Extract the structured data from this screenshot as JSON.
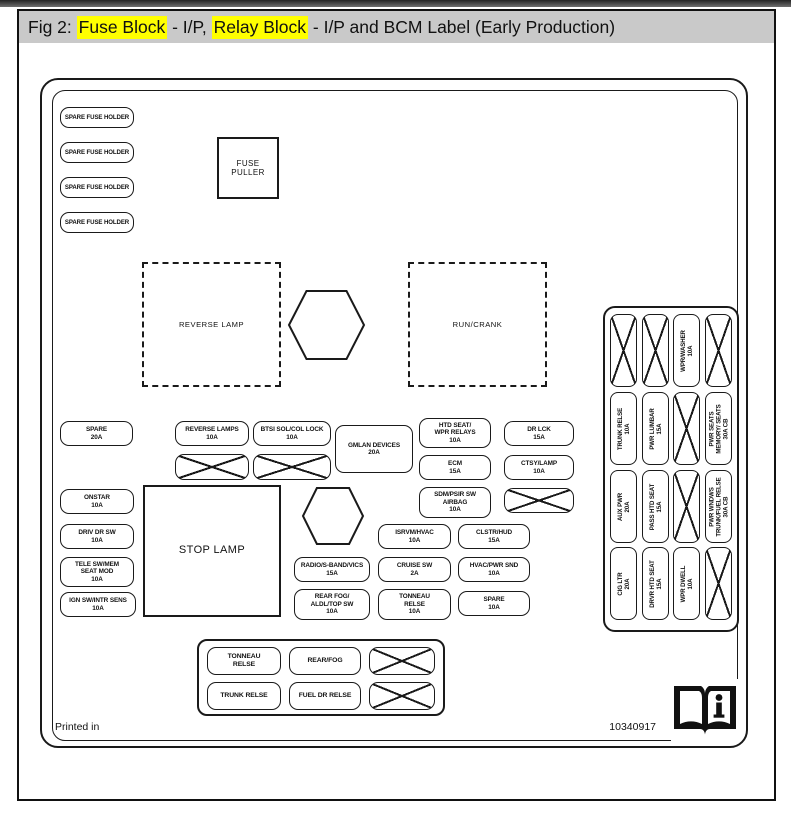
{
  "caption": {
    "prefix": "Fig 2: ",
    "fuse_block": "Fuse Block",
    "sep1": " - I/P, ",
    "relay_block": "Relay Block",
    "sep2": " - I/P and BCM Label (Early Production)"
  },
  "colors": {
    "highlight": "#ffff00",
    "caption_bg": "#c9c9c9",
    "line": "#1a1a1a"
  },
  "diagram": {
    "spare_fuse_holders": [
      "SPARE FUSE HOLDER",
      "SPARE FUSE HOLDER",
      "SPARE FUSE HOLDER",
      "SPARE FUSE HOLDER"
    ],
    "fuse_puller_lines": [
      "FUSE",
      "PULLER"
    ],
    "dashed_boxes": [
      {
        "label": "REVERSE LAMP",
        "x": 142,
        "y": 262,
        "w": 139,
        "h": 125
      },
      {
        "label": "RUN/CRANK",
        "x": 408,
        "y": 262,
        "w": 139,
        "h": 125
      }
    ],
    "stop_lamp": {
      "label": "STOP LAMP",
      "x": 143,
      "y": 485,
      "w": 138,
      "h": 132
    },
    "hexagons": [
      {
        "x": 288,
        "y": 290,
        "w": 77,
        "h": 70
      },
      {
        "x": 302,
        "y": 487,
        "w": 62,
        "h": 58
      }
    ],
    "fuses": [
      {
        "x": 60,
        "y": 421,
        "w": 73,
        "h": 25,
        "lines": [
          "SPARE",
          "20A"
        ]
      },
      {
        "x": 175,
        "y": 421,
        "w": 74,
        "h": 25,
        "lines": [
          "REVERSE LAMPS",
          "10A"
        ]
      },
      {
        "x": 253,
        "y": 421,
        "w": 78,
        "h": 25,
        "lines": [
          "BTSI SOL/COL LOCK",
          "10A"
        ]
      },
      {
        "x": 335,
        "y": 425,
        "w": 78,
        "h": 48,
        "lines": [
          "GMLAN DEVICES",
          "20A"
        ]
      },
      {
        "x": 419,
        "y": 418,
        "w": 72,
        "h": 30,
        "lines": [
          "HTD SEAT/",
          "WPR RELAYS",
          "10A"
        ]
      },
      {
        "x": 504,
        "y": 421,
        "w": 70,
        "h": 25,
        "lines": [
          "DR LCK",
          "15A"
        ]
      },
      {
        "x": 419,
        "y": 455,
        "w": 72,
        "h": 25,
        "lines": [
          "ECM",
          "15A"
        ]
      },
      {
        "x": 504,
        "y": 455,
        "w": 70,
        "h": 25,
        "lines": [
          "CTSY/LAMP",
          "10A"
        ]
      },
      {
        "x": 419,
        "y": 487,
        "w": 72,
        "h": 31,
        "lines": [
          "SDM/PSIR SW",
          "AIRBAG",
          "10A"
        ]
      },
      {
        "x": 60,
        "y": 489,
        "w": 74,
        "h": 25,
        "lines": [
          "ONSTAR",
          "10A"
        ]
      },
      {
        "x": 60,
        "y": 524,
        "w": 74,
        "h": 25,
        "lines": [
          "DRIV DR SW",
          "10A"
        ]
      },
      {
        "x": 60,
        "y": 557,
        "w": 74,
        "h": 30,
        "lines": [
          "TELE SW/MEM",
          "SEAT MOD",
          "10A"
        ]
      },
      {
        "x": 60,
        "y": 592,
        "w": 76,
        "h": 25,
        "lines": [
          "IGN SW/INTR SENS",
          "10A"
        ]
      },
      {
        "x": 378,
        "y": 524,
        "w": 73,
        "h": 25,
        "lines": [
          "ISRVM/HVAC",
          "10A"
        ]
      },
      {
        "x": 458,
        "y": 524,
        "w": 72,
        "h": 25,
        "lines": [
          "CLSTR/HUD",
          "15A"
        ]
      },
      {
        "x": 294,
        "y": 557,
        "w": 76,
        "h": 25,
        "lines": [
          "RADIO/S-BAND/VICS",
          "15A"
        ]
      },
      {
        "x": 378,
        "y": 557,
        "w": 73,
        "h": 25,
        "lines": [
          "CRUISE SW",
          "2A"
        ]
      },
      {
        "x": 458,
        "y": 557,
        "w": 72,
        "h": 25,
        "lines": [
          "HVAC/PWR SND",
          "10A"
        ]
      },
      {
        "x": 294,
        "y": 589,
        "w": 76,
        "h": 31,
        "lines": [
          "REAR FOG/",
          "ALDL/TOP SW",
          "10A"
        ]
      },
      {
        "x": 378,
        "y": 589,
        "w": 73,
        "h": 31,
        "lines": [
          "TONNEAU",
          "RELSE",
          "10A"
        ]
      },
      {
        "x": 458,
        "y": 591,
        "w": 72,
        "h": 25,
        "lines": [
          "SPARE",
          "10A"
        ]
      }
    ],
    "crossed_boxes": [
      {
        "x": 175,
        "y": 454,
        "w": 74,
        "h": 26
      },
      {
        "x": 253,
        "y": 454,
        "w": 78,
        "h": 26
      },
      {
        "x": 504,
        "y": 488,
        "w": 70,
        "h": 25
      }
    ],
    "right_panel": {
      "x": 603,
      "y": 306,
      "w": 136,
      "h": 326,
      "col_x": [
        610,
        642,
        673,
        705
      ],
      "row_y": [
        314,
        392,
        470,
        547
      ],
      "fuse_w": 27,
      "fuse_h": 73,
      "fuses": [
        {
          "c": 0,
          "r": 0
        },
        {
          "c": 1,
          "r": 0
        },
        {
          "c": 2,
          "r": 0,
          "lines": [
            "WPR/WASHER",
            "10A"
          ]
        },
        {
          "c": 3,
          "r": 0
        },
        {
          "c": 0,
          "r": 1,
          "lines": [
            "TRUNK RELSE",
            "10A"
          ]
        },
        {
          "c": 1,
          "r": 1,
          "lines": [
            "PWR LUMBAR",
            "15A"
          ]
        },
        {
          "c": 2,
          "r": 1
        },
        {
          "c": 3,
          "r": 1,
          "lines": [
            "PWR SEATS",
            "MEMORY/ SEATS",
            "30A CB"
          ]
        },
        {
          "c": 0,
          "r": 2,
          "lines": [
            "AUX PWR",
            "20A"
          ]
        },
        {
          "c": 1,
          "r": 2,
          "lines": [
            "PASS HTD SEAT",
            "15A"
          ]
        },
        {
          "c": 2,
          "r": 2
        },
        {
          "c": 3,
          "r": 2,
          "lines": [
            "PWR WNDWS",
            "TRUNK/FUEL RELSE",
            "30A CB"
          ]
        },
        {
          "c": 0,
          "r": 3,
          "lines": [
            "CIG LTR",
            "20A"
          ]
        },
        {
          "c": 1,
          "r": 3,
          "lines": [
            "DRVR HTD SEAT",
            "15A"
          ]
        },
        {
          "c": 2,
          "r": 3,
          "lines": [
            "WPR DWELL",
            "10A"
          ]
        },
        {
          "c": 3,
          "r": 3
        }
      ]
    },
    "relay_block": {
      "x": 197,
      "y": 639,
      "w": 248,
      "h": 77,
      "relays": [
        {
          "x": 207,
          "y": 647,
          "w": 74,
          "h": 28,
          "lines": [
            "TONNEAU",
            "RELSE"
          ]
        },
        {
          "x": 289,
          "y": 647,
          "w": 72,
          "h": 28,
          "lines": [
            "REAR/FOG"
          ]
        },
        {
          "x": 369,
          "y": 647,
          "w": 66,
          "h": 28
        },
        {
          "x": 207,
          "y": 682,
          "w": 74,
          "h": 28,
          "lines": [
            "TRUNK RELSE"
          ]
        },
        {
          "x": 289,
          "y": 682,
          "w": 72,
          "h": 28,
          "lines": [
            "FUEL DR RELSE"
          ]
        },
        {
          "x": 369,
          "y": 682,
          "w": 66,
          "h": 28
        }
      ]
    },
    "footer": {
      "printed_in": "Printed in",
      "part_number": "10340917"
    }
  }
}
